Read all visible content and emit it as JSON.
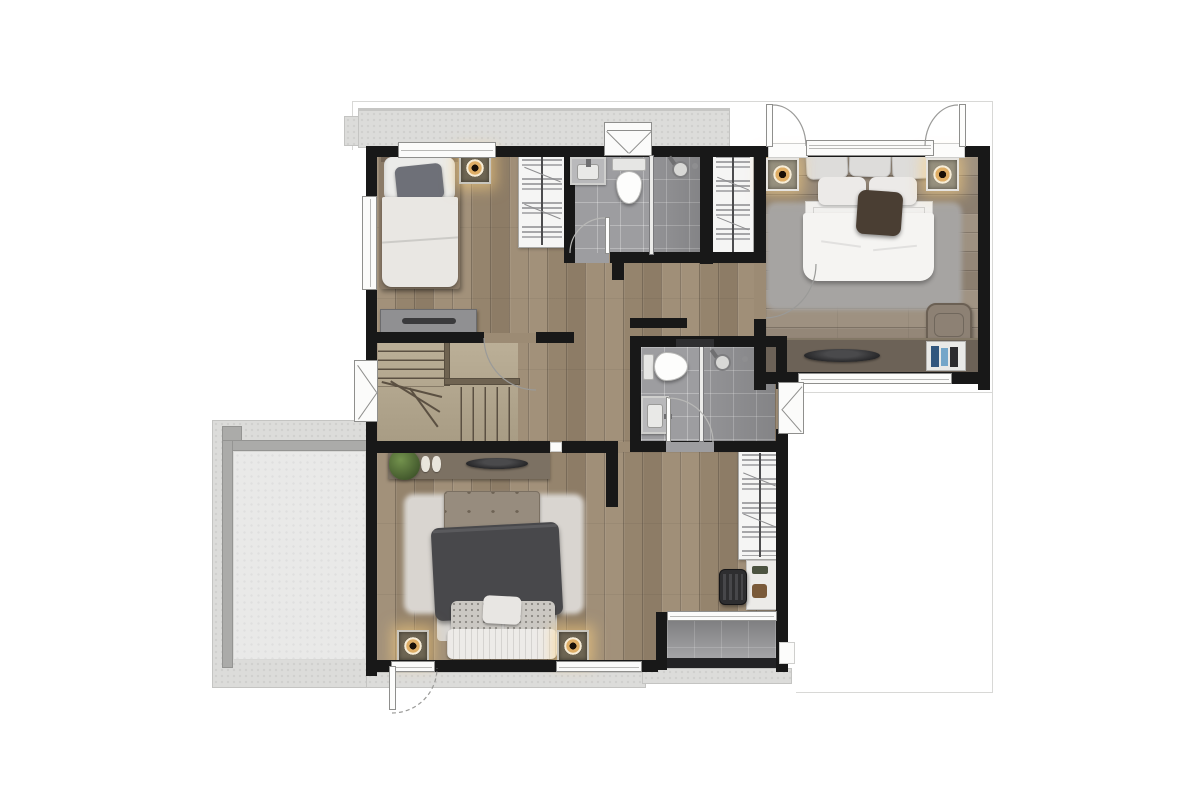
{
  "scene": {
    "type": "floor-plan",
    "view": "top-down 3d render",
    "floor_label": "Upper floor",
    "canvas": {
      "width": 1200,
      "height": 800
    }
  },
  "palette": {
    "background": "#ffffff",
    "walls": "#181818",
    "wood_floor": "#9c8b74",
    "wood_floor_master": "#988b7b",
    "bathroom_tile": "#9d9da0",
    "glass_partition": "#ececea",
    "concrete_ledge": "#dcdcda",
    "roof_terrace": "#e9e9e8",
    "parapet": "#ababa9",
    "balcony_tile": "#8e8e90",
    "rug_gray": "#a6a4a2",
    "rug_white": "#d9d5d0",
    "dark_bedding": "#48484b",
    "console_wood": "#6c6257",
    "stair_wood": "#b0a48c",
    "accent_gold": "#dfae66",
    "spotlight_glow": "#ffd382"
  },
  "rooms": [
    {
      "id": "bedroom-small",
      "label": "Small bedroom with single bed, wardrobe and dresser"
    },
    {
      "id": "bathroom-top",
      "label": "Bathroom with basin, toilet and glass shower"
    },
    {
      "id": "master-bedroom",
      "label": "Master bedroom with double bed, rug, console desk and chair"
    },
    {
      "id": "hallway-stairs",
      "label": "Hallway with L-shaped staircase and console table"
    },
    {
      "id": "bathroom-middle",
      "label": "Second bathroom with basin, toilet and glass shower"
    },
    {
      "id": "bedroom-bottom",
      "label": "Bedroom with double bed, bench headboard and white rug"
    },
    {
      "id": "closet-nook",
      "label": "Wardrobe and desk nook"
    },
    {
      "id": "roof-terrace",
      "label": "Concrete roof terrace"
    },
    {
      "id": "balcony",
      "label": "Tiled balcony"
    }
  ],
  "furniture_inventory": [
    "single-bed",
    "double-bed",
    "double-bed-dark",
    "wardrobe x3",
    "dresser",
    "console-table x2",
    "desk",
    "office-chair",
    "lounge-chair",
    "bookshelf",
    "plant",
    "slippers",
    "decor-bowl x2",
    "area-rug x2",
    "ceiling-spotlight x5",
    "toilet x2",
    "washbasin x2",
    "shower-head x2",
    "glass-partition x2",
    "l-shaped-staircase"
  ],
  "openings": {
    "windows": 7,
    "awning_window_symbols": 3,
    "exterior_door_swings": 2,
    "interior_door_swings": 4,
    "dashed_door_swing": 1
  }
}
